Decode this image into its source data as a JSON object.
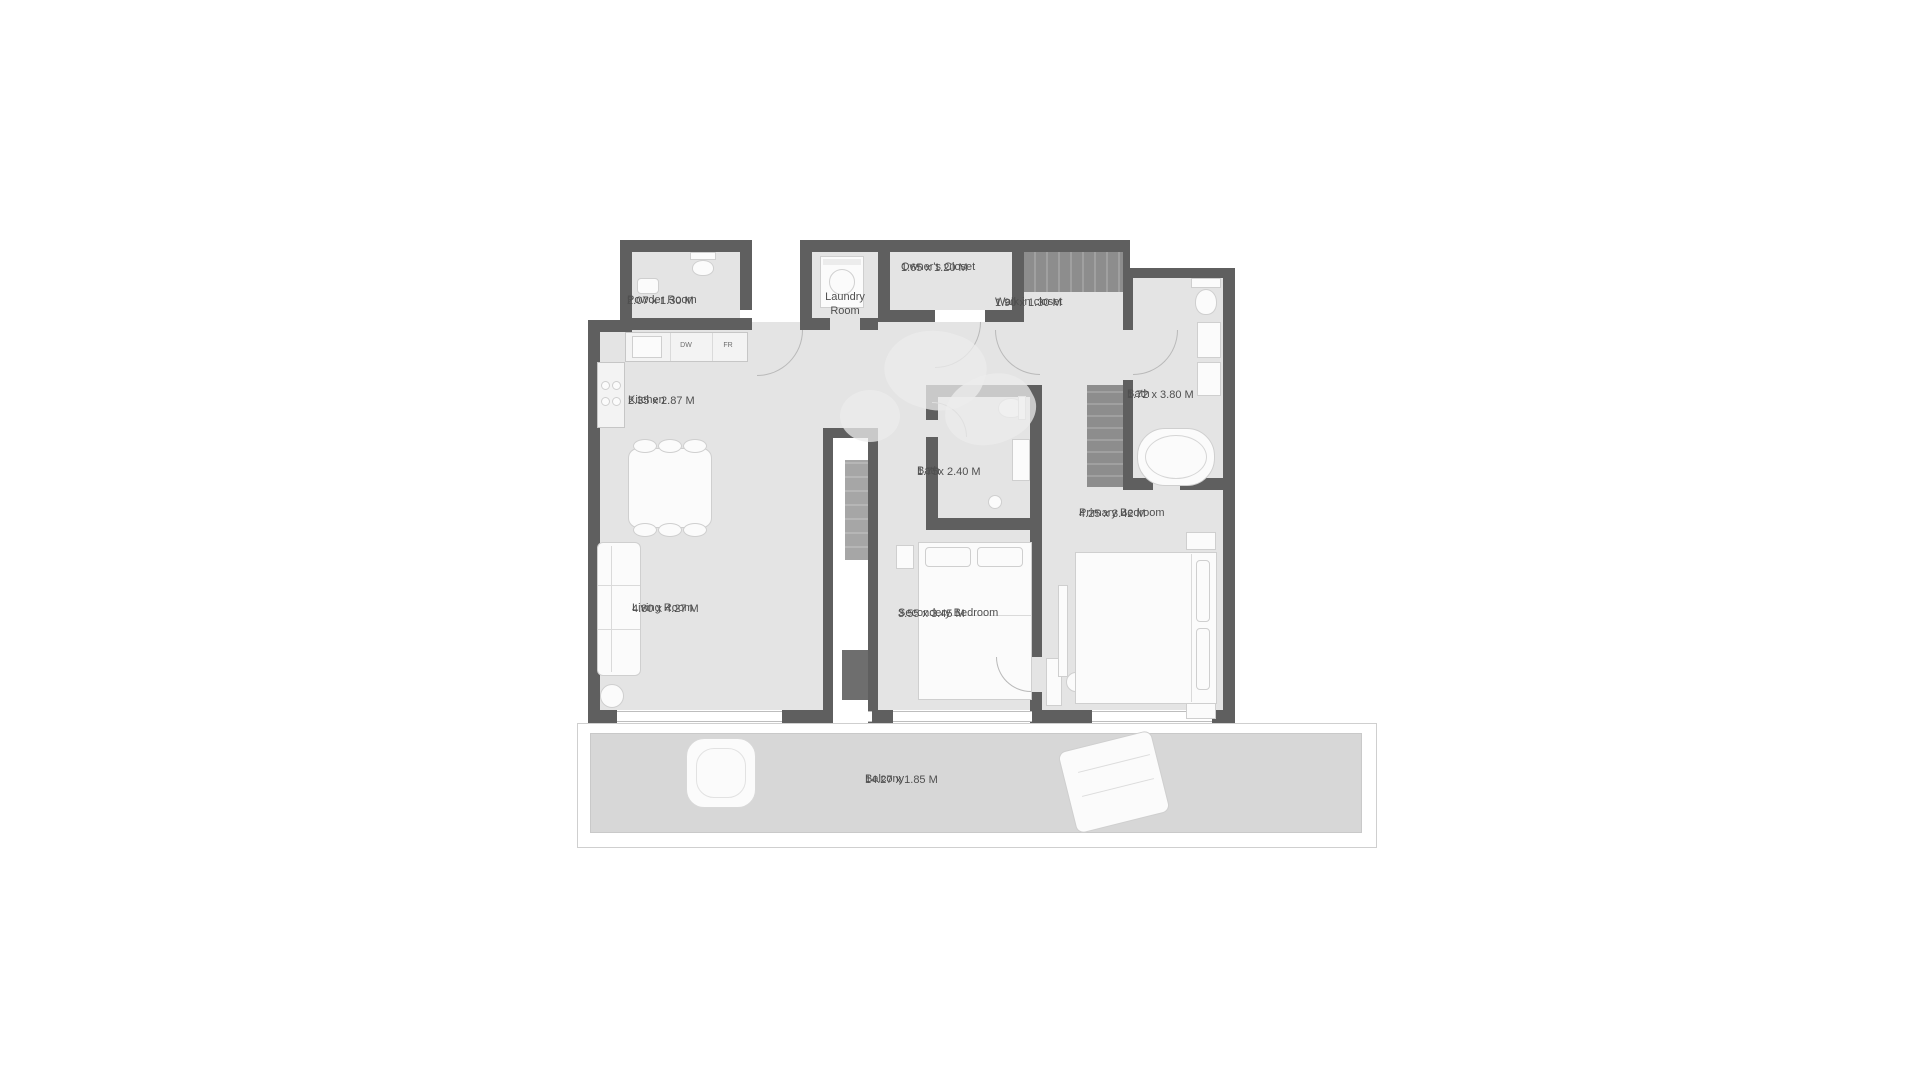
{
  "plan": {
    "rooms": {
      "powder": {
        "name": "Powder Room",
        "dims": "2.07 x 1.30 M"
      },
      "laundry": {
        "name": "Laundry Room"
      },
      "owners_closet": {
        "name": "Owner's Closet",
        "dims": "1.65 x 1.20 M"
      },
      "walk_in_closet": {
        "name": "Walk in closet",
        "dims": "1.90 x 1.30 M"
      },
      "kitchen": {
        "name": "Kitchen",
        "dims": "2.35 x 2.87 M"
      },
      "bath_main": {
        "name": "Bath",
        "dims": "1.72 x 3.80 M"
      },
      "bath_shared": {
        "name": "Bath",
        "dims": "1.75x 2.40 M"
      },
      "primary_bedroom": {
        "name": "Primary Bedroom",
        "dims": "4.25 x 3.42 M"
      },
      "living_room": {
        "name": "Living Room",
        "dims": "4.80 x 4.27 M"
      },
      "secondary_bedroom": {
        "name": "Secondery Bedroom",
        "dims": "3.55 x 3.45 M"
      },
      "balcony": {
        "name": "Balcony",
        "dims": "14.27 x 1.85 M"
      }
    },
    "appliance_labels": {
      "dishwasher": "DW",
      "fridge": "FR"
    },
    "colors": {
      "wall": "#5f5f5f",
      "floor": "#e4e4e4",
      "balcony_floor": "#d7d7d7",
      "closet_shelving": "#8f8f8f",
      "label_text": "#4f4f4f"
    }
  }
}
